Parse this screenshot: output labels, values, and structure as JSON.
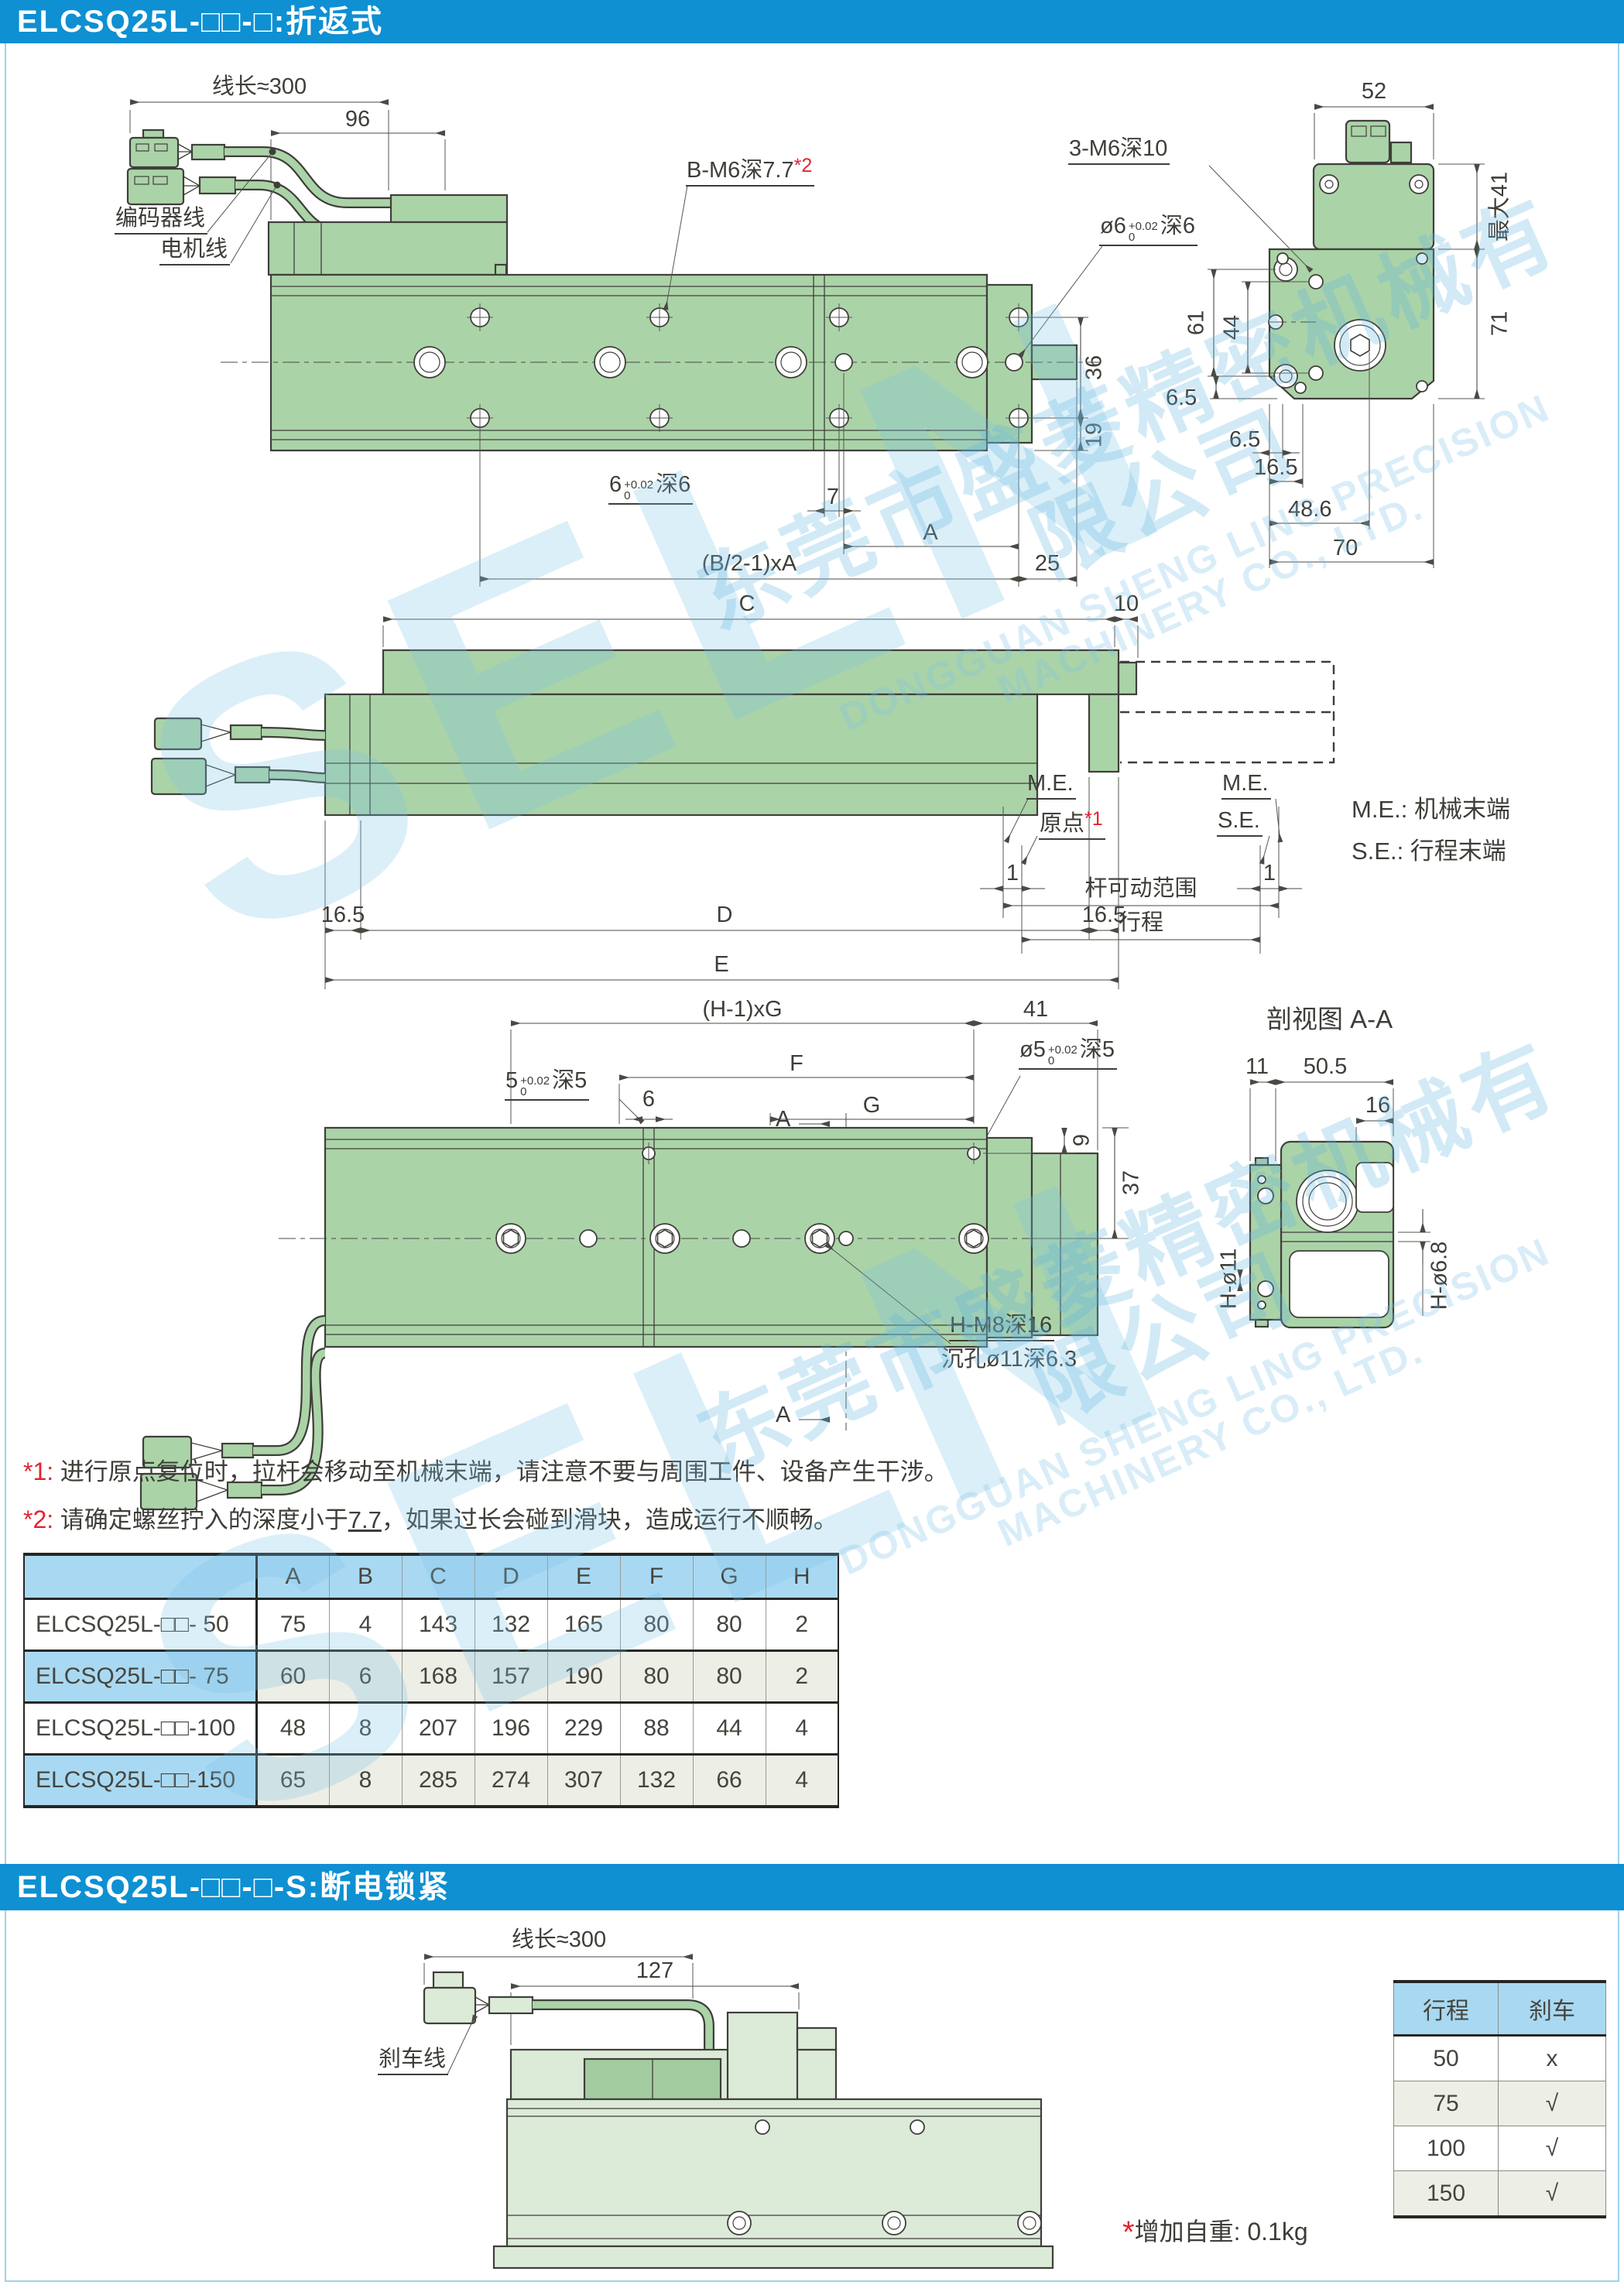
{
  "wm": {
    "brand": "SELN",
    "cn": "东莞市盛菱精密机械有限公司",
    "en": "DONGGUAN SHENG LING PRECISION MACHINERY CO., LTD."
  },
  "s1": {
    "title": "ELCSQ25L-□□-□:折返式",
    "topview": {
      "len": "线长≈300",
      "d96": "96",
      "enc": "编码器线",
      "mot": "电机线",
      "bm6": "B-M6深7.7",
      "bm6ref": "*2",
      "o6": "ø6",
      "o6u": "+0.02",
      "o6l": "0",
      "o6s": "深6",
      "d36": "36",
      "d19": "19",
      "s6": "6",
      "s6u": "+0.02",
      "s6l": "0",
      "s6s": "深6",
      "d7": "7",
      "dA": "A",
      "pitch": "(B/2-1)xA",
      "d25": "25"
    },
    "endview": {
      "d52": "52",
      "m6": "3-M6深10",
      "max41": "最大41",
      "d71": "71",
      "d61": "61",
      "d44": "44",
      "d65a": "6.5",
      "d65b": "6.5",
      "d165": "16.5",
      "d486": "48.6",
      "d70": "70"
    },
    "sideview": {
      "dC": "C",
      "d10": "10",
      "meL": "M.E.",
      "meR": "M.E.",
      "se": "S.E.",
      "origin": "原点",
      "originRef": "*1",
      "d1L": "1",
      "d1R": "1",
      "range": "杆可动范围",
      "stroke": "行程",
      "d165L": "16.5",
      "dD": "D",
      "d165R": "16.5",
      "dE": "E",
      "legendMe": "M.E.: 机械末端",
      "legendSe": "S.E.: 行程末端"
    },
    "bottomview": {
      "pitch": "(H-1)xG",
      "d41": "41",
      "dF": "F",
      "dG": "G",
      "d6": "6",
      "s5": "5",
      "s5u": "+0.02",
      "s5l": "0",
      "s5s": "深5",
      "mA1": "A",
      "mA2": "A",
      "o5": "ø5",
      "o5u": "+0.02",
      "o5l": "0",
      "o5s": "深5",
      "d9": "9",
      "d37": "37",
      "m8": "H-M8深16",
      "cb": "沉孔ø11深6.3"
    },
    "secview": {
      "title": "剖视图 A-A",
      "d11": "11",
      "d505": "50.5",
      "d16": "16",
      "h11": "H-ø11",
      "h68": "H-ø6.8"
    },
    "notes": {
      "n1ref": "*1:",
      "n1": "进行原点复位时，拉杆会移动至机械末端，请注意不要与周围工件、设备产生干涉。",
      "n2ref": "*2:",
      "n2a": "请确定螺丝拧入的深度小于",
      "n2b": "7.7",
      "n2c": "，如果过长会碰到滑块，造成运行不顺畅。"
    },
    "table": {
      "h": [
        "A",
        "B",
        "C",
        "D",
        "E",
        "F",
        "G",
        "H"
      ],
      "rows": [
        {
          "m": "ELCSQ25L-□□- 50",
          "v": [
            "75",
            "4",
            "143",
            "132",
            "165",
            "80",
            "80",
            "2"
          ]
        },
        {
          "m": "ELCSQ25L-□□- 75",
          "v": [
            "60",
            "6",
            "168",
            "157",
            "190",
            "80",
            "80",
            "2"
          ]
        },
        {
          "m": "ELCSQ25L-□□-100",
          "v": [
            "48",
            "8",
            "207",
            "196",
            "229",
            "88",
            "44",
            "4"
          ]
        },
        {
          "m": "ELCSQ25L-□□-150",
          "v": [
            "65",
            "8",
            "285",
            "274",
            "307",
            "132",
            "66",
            "4"
          ]
        }
      ]
    }
  },
  "s2": {
    "title": "ELCSQ25L-□□-□-S:断电锁紧",
    "len": "线长≈300",
    "d127": "127",
    "brake": "刹车线",
    "noteRef": "*",
    "note": "增加自重: 0.1kg",
    "table": {
      "h1": "行程",
      "h2": "刹车",
      "rows": [
        {
          "s": "50",
          "b": "x"
        },
        {
          "s": "75",
          "b": "√"
        },
        {
          "s": "100",
          "b": "√"
        },
        {
          "s": "150",
          "b": "√"
        }
      ]
    }
  }
}
